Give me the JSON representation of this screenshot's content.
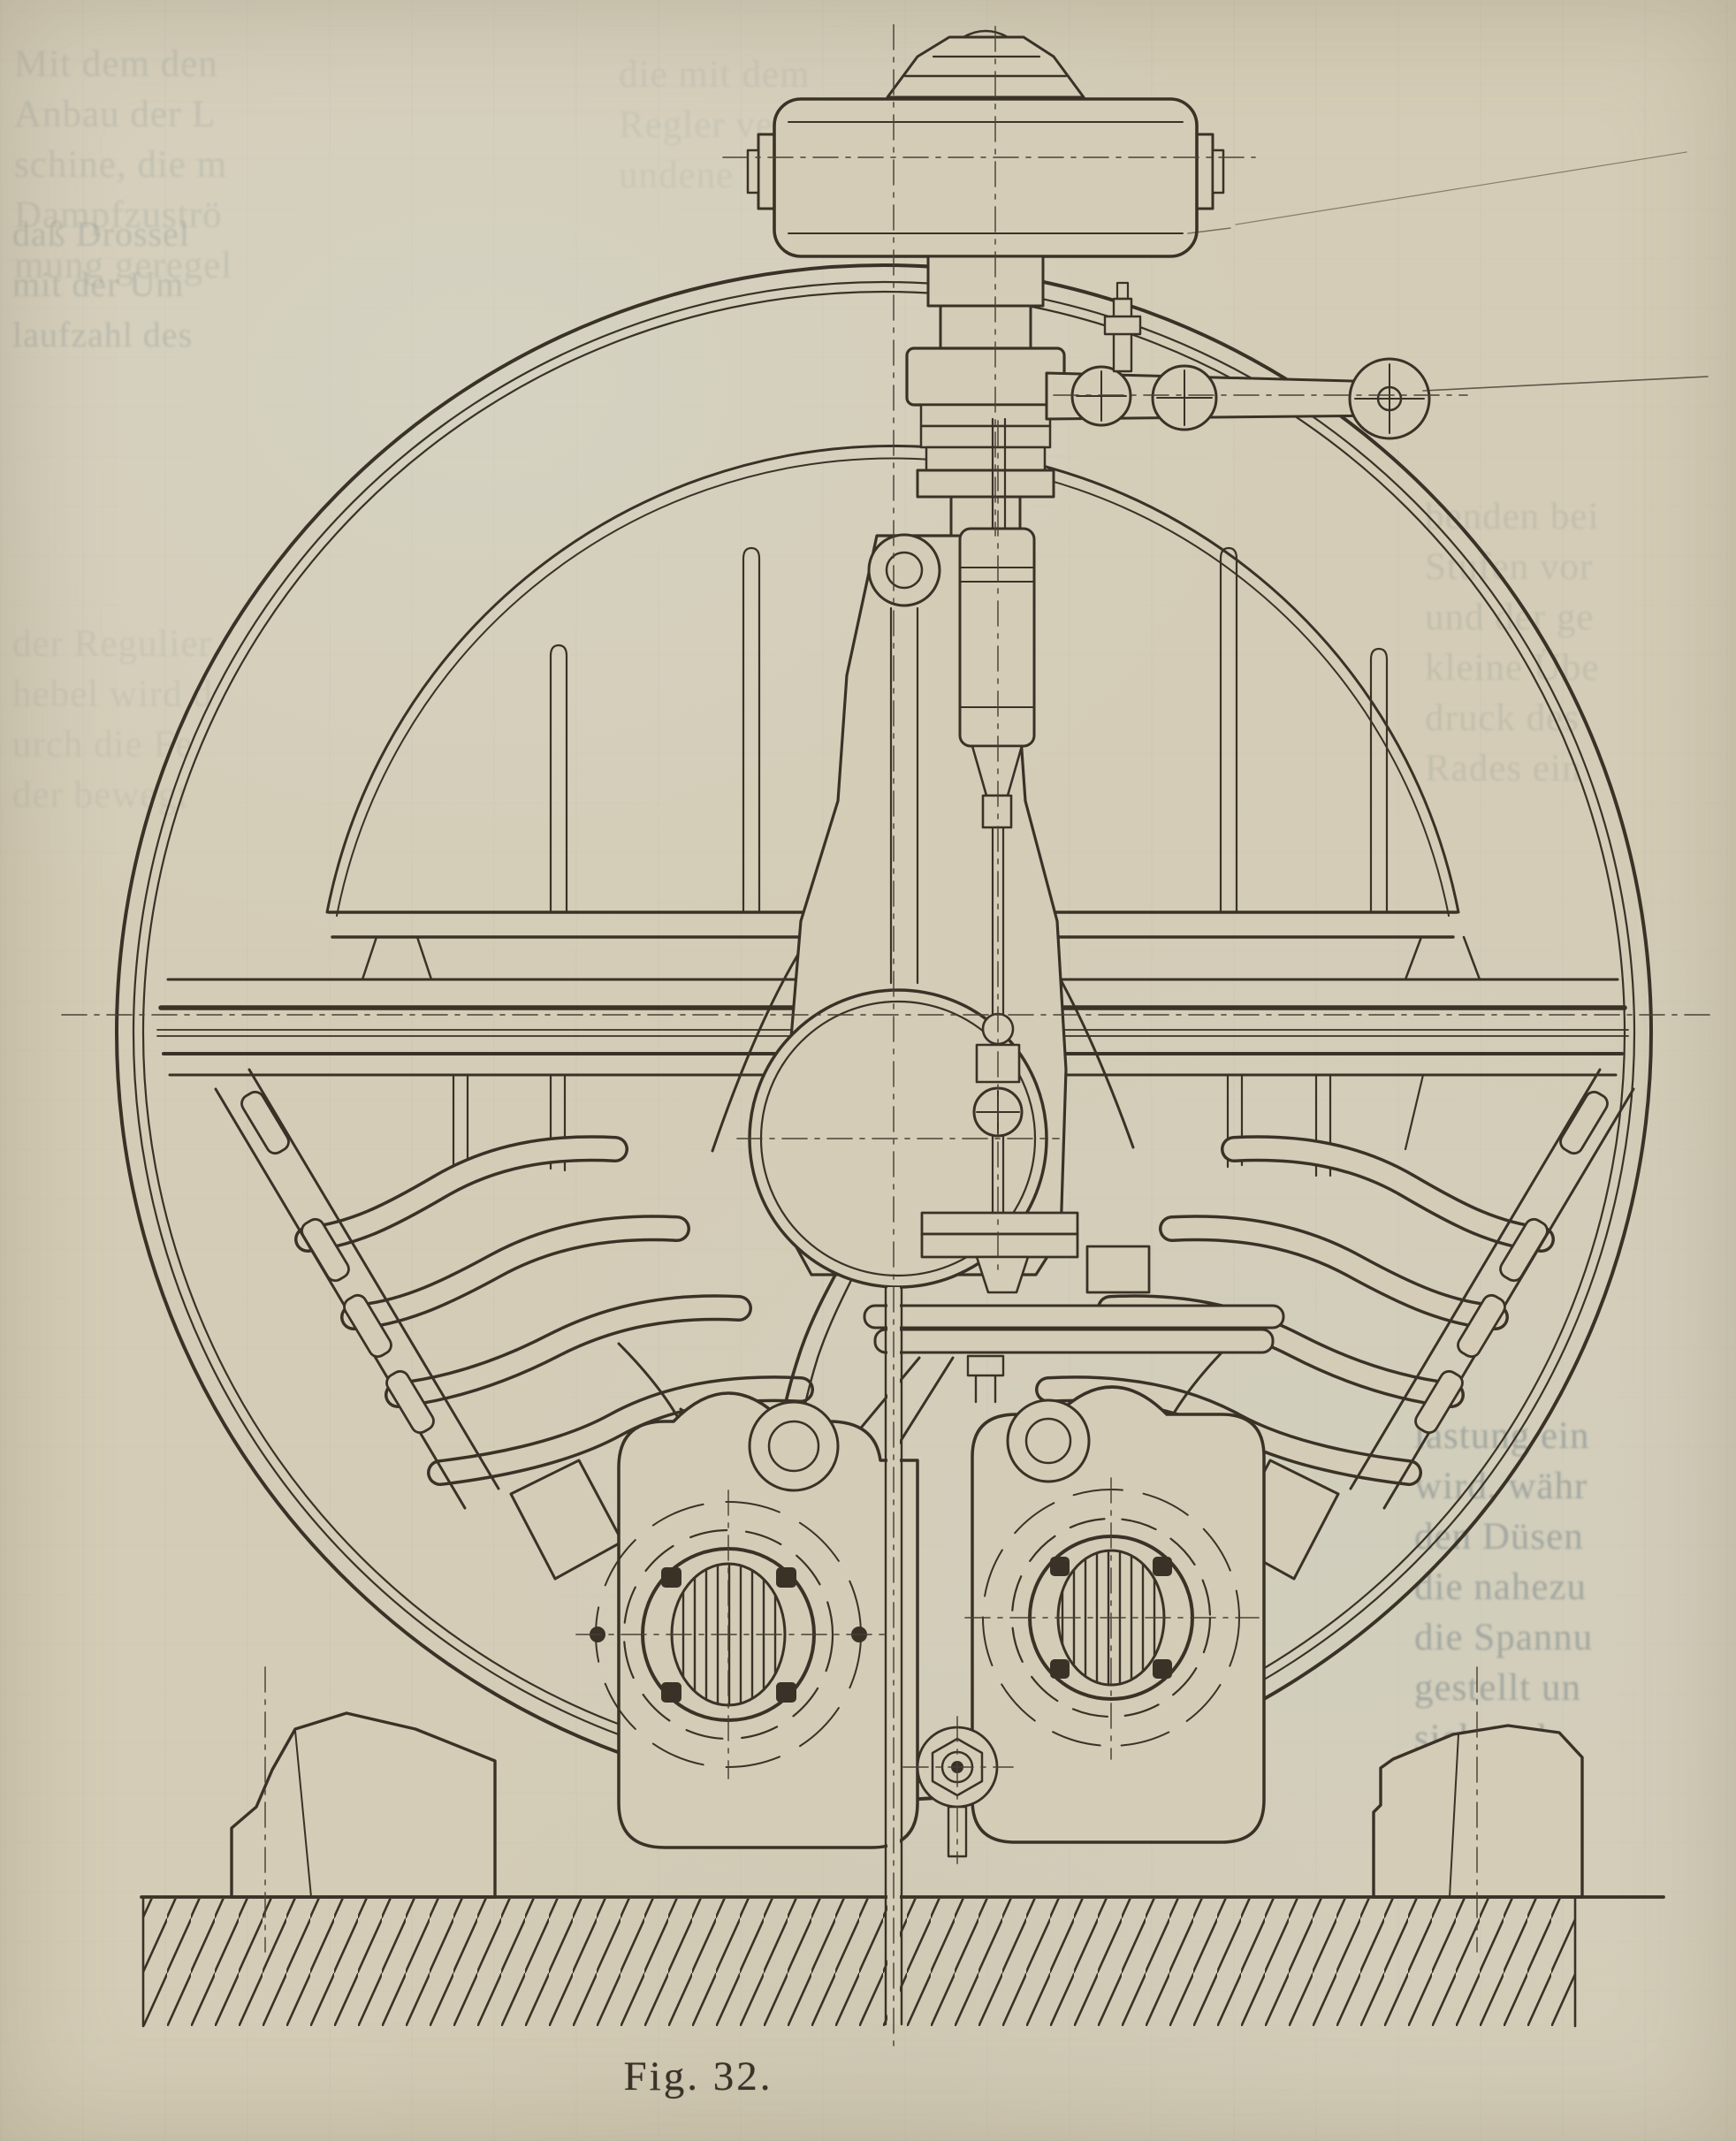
{
  "page": {
    "kind": "scanned book page with engraved technical figure",
    "caption": "Fig. 32."
  },
  "figure": {
    "alt": "Sectional line drawing of a steam turbine wheel with speed governor on top, nozzle pipe groups, flanged valve-chest openings, pedestal feet and hatched foundation",
    "number": "Fig. 32."
  },
  "colors": {
    "paper": "#d4ccb6",
    "ink": "#3a3227",
    "centerline_ink": "#4a4136",
    "ghost_text": "#5d7078",
    "caption_ink": "#3a3128"
  },
  "ghost_text": {
    "note": "faint show-through text from adjacent page, partially legible",
    "top_left": {
      "lines": [
        "Mit dem den",
        "Anbau der L",
        "schine, die m",
        "Dampfzuströ",
        "mung geregel"
      ]
    },
    "top_left_lower": {
      "lines": [
        "daß Drossel",
        "mit der Um",
        "laufzahl des"
      ]
    },
    "top_center": {
      "lines": [
        "die mit dem",
        "Regler verb",
        "undene Dro"
      ]
    },
    "mid_left": {
      "lines": [
        "der Regulier",
        "hebel wird d",
        "urch die Fe",
        "der bewegt"
      ]
    },
    "right_middle": {
      "lines": [
        "benden bei",
        "Stufen vor",
        "und der ge",
        "kleine Übe",
        "druck des",
        "Rades ein"
      ]
    },
    "bottom_right": {
      "lines": [
        "lastung ein",
        "wird, währ",
        "den Düsen",
        "die nahezu",
        "die Spannu",
        "gestellt un",
        "sich ände",
        "der therm",
        "grad selbs"
      ]
    }
  }
}
